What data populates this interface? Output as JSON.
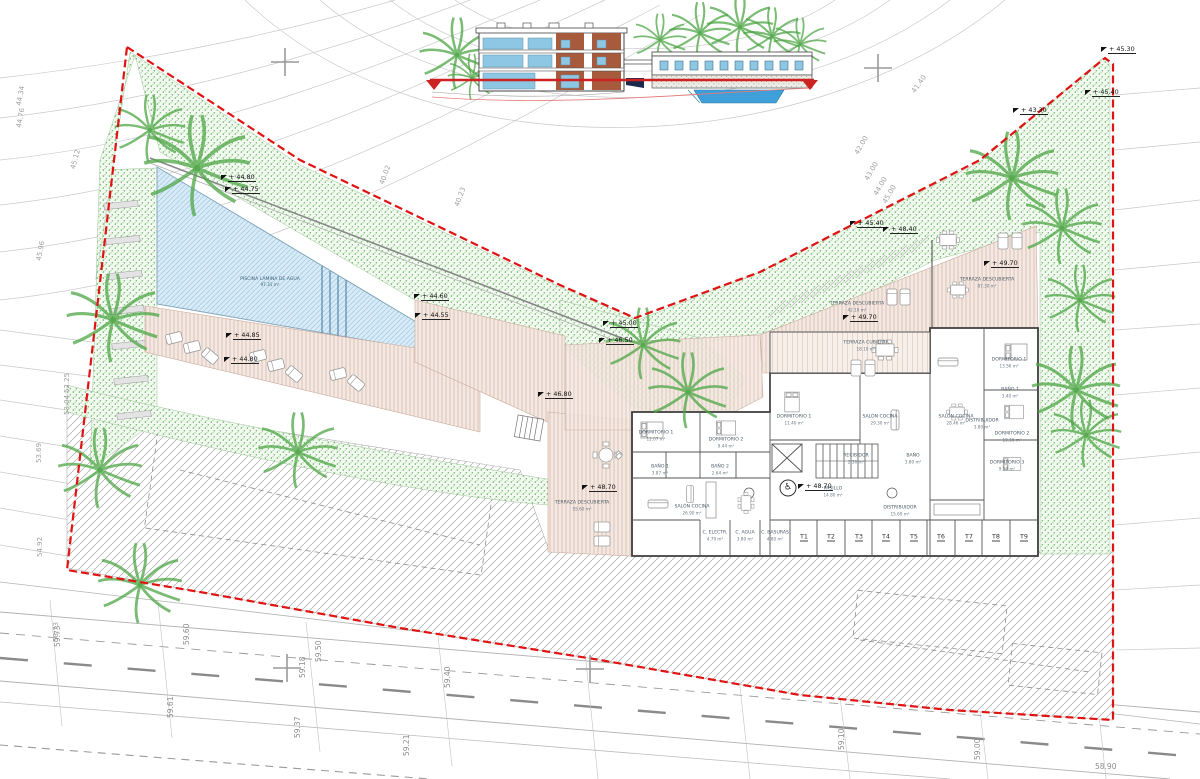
{
  "drawing": {
    "type": "architectural-site-plan-ground-floor",
    "colors": {
      "boundary_red": "#e11212",
      "grass_green": "#58ab4e",
      "pool_blue": "#cfe6f4",
      "deck_tan": "#f2e3da",
      "wall_gray": "#3c3c3c",
      "datum_red": "#cc2222",
      "elevation_glass_blue": "#8ec7e3",
      "elevation_brown": "#a85a3c"
    },
    "icons": {
      "wheelchair": "♿"
    },
    "pool": {
      "label": "PISCINA LÁMINA DE AGUA",
      "area": "97.31 m²"
    },
    "storage_units": {
      "labels": [
        "T1",
        "T2",
        "T3",
        "T4",
        "T5",
        "T6",
        "T7",
        "T8",
        "T9"
      ],
      "xs": [
        804,
        831,
        859,
        886,
        914,
        941,
        969,
        996,
        1024
      ],
      "y": 537
    },
    "rooms": [
      {
        "x": 582,
        "y": 506,
        "label": "TERRAZA DESCUBIERTA",
        "area": "55.60 m²"
      },
      {
        "x": 656,
        "y": 436,
        "label": "DORMITORIO 1",
        "area": "12.07 m²"
      },
      {
        "x": 726,
        "y": 443,
        "label": "DORMITORIO 2",
        "area": "9.44 m²"
      },
      {
        "x": 660,
        "y": 470,
        "label": "BAÑO 1",
        "area": "3.87 m²"
      },
      {
        "x": 720,
        "y": 470,
        "label": "BAÑO 2",
        "area": "2.64 m²"
      },
      {
        "x": 692,
        "y": 510,
        "label": "SALÓN COCINA",
        "area": "26.90 m²"
      },
      {
        "x": 866,
        "y": 346,
        "label": "TERRAZA CUBIERTA",
        "area": "18.10 m²"
      },
      {
        "x": 794,
        "y": 420,
        "label": "DORMITORIO 1",
        "area": "11.40 m²"
      },
      {
        "x": 880,
        "y": 420,
        "label": "SALÓN COCINA",
        "area": "29.30 m²"
      },
      {
        "x": 856,
        "y": 459,
        "label": "RECIBIDOR",
        "area": "2.36 m²"
      },
      {
        "x": 913,
        "y": 459,
        "label": "BAÑO",
        "area": "3.80 m²"
      },
      {
        "x": 833,
        "y": 492,
        "label": "PASILLO",
        "area": "14.80 m²"
      },
      {
        "x": 900,
        "y": 511,
        "label": "DISTRIBUIDOR",
        "area": "15.60 m²"
      },
      {
        "x": 956,
        "y": 420,
        "label": "SALÓN COCINA",
        "area": "28.46 m²"
      },
      {
        "x": 1009,
        "y": 363,
        "label": "DORMITORIO 1",
        "area": "13.56 m²"
      },
      {
        "x": 1010,
        "y": 393,
        "label": "BAÑO 1",
        "area": "3.40 m²"
      },
      {
        "x": 982,
        "y": 424,
        "label": "DISTRIBUIDOR",
        "area": "3.80 m²"
      },
      {
        "x": 1012,
        "y": 437,
        "label": "DORMITORIO 2",
        "area": "10.16 m²"
      },
      {
        "x": 1007,
        "y": 466,
        "label": "DORMITORIO 3",
        "area": "9.00 m²"
      },
      {
        "x": 987,
        "y": 283,
        "label": "TERRAZA DESCUBIERTA",
        "area": "87.30 m²"
      },
      {
        "x": 857,
        "y": 307,
        "label": "TERRAZA DESCUBIERTA",
        "area": "42.10 m²"
      },
      {
        "x": 715,
        "y": 536,
        "label": "C. ELECTR.",
        "area": "4.70 m²"
      },
      {
        "x": 745,
        "y": 536,
        "label": "C. AGUA",
        "area": "3.80 m²"
      },
      {
        "x": 775,
        "y": 536,
        "label": "C. BASURAS",
        "area": "4.80 m²"
      }
    ],
    "elevation_markers": [
      {
        "x": 223,
        "y": 180,
        "label": "+ 44.80"
      },
      {
        "x": 227,
        "y": 192,
        "label": "+ 44.75"
      },
      {
        "x": 228,
        "y": 338,
        "label": "+ 44.85"
      },
      {
        "x": 226,
        "y": 362,
        "label": "+ 44.80"
      },
      {
        "x": 416,
        "y": 299,
        "label": "+ 44.60"
      },
      {
        "x": 417,
        "y": 318,
        "label": "+ 44.55"
      },
      {
        "x": 605,
        "y": 326,
        "label": "+ 45.00"
      },
      {
        "x": 601,
        "y": 343,
        "label": "+ 46.50"
      },
      {
        "x": 540,
        "y": 397,
        "label": "+ 46.80"
      },
      {
        "x": 584,
        "y": 490,
        "label": "+ 48.70"
      },
      {
        "x": 800,
        "y": 489,
        "label": "+ 48.70"
      },
      {
        "x": 986,
        "y": 266,
        "label": "+ 49.70"
      },
      {
        "x": 845,
        "y": 320,
        "label": "+ 49.70"
      },
      {
        "x": 852,
        "y": 226,
        "label": "+ 45.40"
      },
      {
        "x": 885,
        "y": 232,
        "label": "+ 48.40"
      },
      {
        "x": 1015,
        "y": 113,
        "label": "+ 43.30"
      },
      {
        "x": 1087,
        "y": 95,
        "label": "+ 45.40"
      },
      {
        "x": 1103,
        "y": 52,
        "label": "+ 45.30"
      }
    ],
    "contour_labels": [
      {
        "x": 15,
        "y": 105,
        "rot": -80,
        "label": "44.34"
      },
      {
        "x": 15,
        "y": 127,
        "rot": -80,
        "label": "44.76"
      },
      {
        "x": 69,
        "y": 168,
        "rot": -75,
        "label": "45.12"
      },
      {
        "x": 35,
        "y": 260,
        "rot": -80,
        "label": "45.96"
      },
      {
        "x": 63,
        "y": 393,
        "rot": -90,
        "label": "52.25"
      },
      {
        "x": 63,
        "y": 415,
        "rot": -90,
        "label": "53.04"
      },
      {
        "x": 35,
        "y": 463,
        "rot": -90,
        "label": "53.69"
      },
      {
        "x": 36,
        "y": 557,
        "rot": -90,
        "label": "54.92"
      },
      {
        "x": 52,
        "y": 642,
        "rot": -90,
        "label": "58.73"
      },
      {
        "x": 378,
        "y": 183,
        "rot": -70,
        "label": "40.02"
      },
      {
        "x": 453,
        "y": 205,
        "rot": -70,
        "label": "40.23"
      },
      {
        "x": 910,
        "y": 90,
        "rot": -55,
        "label": "41.40"
      },
      {
        "x": 853,
        "y": 152,
        "rot": -60,
        "label": "42.00"
      },
      {
        "x": 863,
        "y": 178,
        "rot": -60,
        "label": "43.00"
      },
      {
        "x": 872,
        "y": 193,
        "rot": -60,
        "label": "44.00"
      },
      {
        "x": 881,
        "y": 201,
        "rot": -60,
        "label": "45.00"
      }
    ],
    "road_labels": [
      {
        "x": 182,
        "y": 645,
        "rot": -90,
        "label": "59.60"
      },
      {
        "x": 314,
        "y": 662,
        "rot": -90,
        "label": "59.50"
      },
      {
        "x": 443,
        "y": 688,
        "rot": -90,
        "label": "59.40"
      },
      {
        "x": 298,
        "y": 678,
        "rot": -90,
        "label": "59.18"
      },
      {
        "x": 166,
        "y": 718,
        "rot": -90,
        "label": "59.61"
      },
      {
        "x": 293,
        "y": 738,
        "rot": -90,
        "label": "59.37"
      },
      {
        "x": 402,
        "y": 756,
        "rot": -90,
        "label": "59.21"
      },
      {
        "x": 53,
        "y": 647,
        "rot": -90,
        "label": "59.73"
      },
      {
        "x": 837,
        "y": 750,
        "rot": -90,
        "label": "59.10"
      },
      {
        "x": 973,
        "y": 760,
        "rot": -90,
        "label": "59.00"
      },
      {
        "x": 1095,
        "y": 762,
        "rot": 0,
        "label": "58.90"
      }
    ]
  }
}
